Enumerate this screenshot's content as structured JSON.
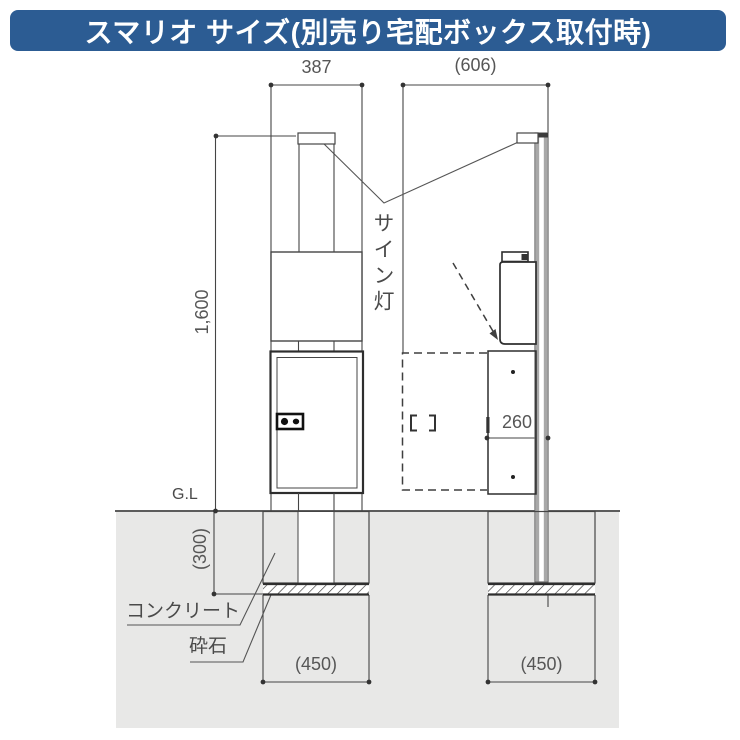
{
  "header": {
    "title": "スマリオ サイズ(別売り宅配ボックス取付時)",
    "bg_color": "#2c5c93",
    "text_color": "#ffffff"
  },
  "diagram": {
    "labels": {
      "sign_light": "サイン灯",
      "ground_level": "G.L",
      "concrete": "コンクリート",
      "crushed_stone": "砕石"
    },
    "dimensions": {
      "front_width": "387",
      "side_total_depth": "(606)",
      "total_height": "1,600",
      "box_depth": "260",
      "foundation_depth": "(300)",
      "foundation_width_front": "(450)",
      "foundation_width_side": "(450)"
    },
    "colors": {
      "ground_gray": "#e8e8e7",
      "line": "#454545",
      "panel_gray": "#a8a8a8"
    }
  }
}
